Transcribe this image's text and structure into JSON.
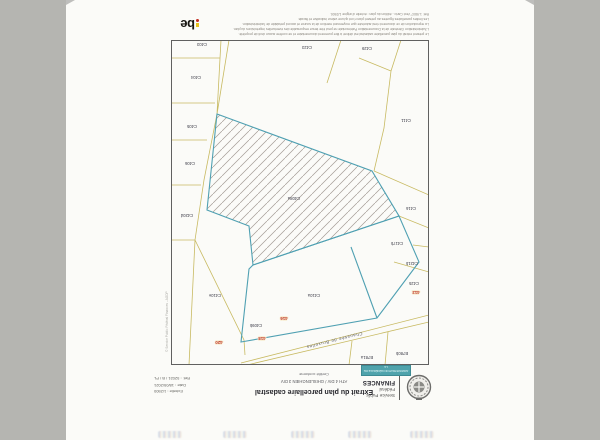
{
  "window": {
    "background": "#b5b5b1",
    "paper": "#fbfbf8"
  },
  "header": {
    "agency": {
      "line1": "Service Public",
      "line2": "Fédéral",
      "line3": "FINANCES"
    },
    "title": "Extrait du plan parcellaire cadastral",
    "division_line": "ATH 4 DIV / GHISLENGHIEN 3 DIV",
    "certified_line": "Certifié conforme",
    "info": {
      "scale": "Echelle : 1/2500",
      "date": "Date : 18/05/2021",
      "ref": "Réf. : 52021 / B / PL"
    },
    "stamp": {
      "line1": "ADMINISTRATION GÉNÉRALE DE LA",
      "line2": "DOCUMENTATION PATRIMONIALE",
      "color": "#4fa3ac"
    }
  },
  "map": {
    "street_label": "Chaussée de Bruxelles",
    "side_note": "© Service Public Fédéral Finances - AGDP",
    "colors": {
      "parcel_line": "#c8ba62",
      "highlight_line": "#4fa0b2",
      "hatch": "#a59d95",
      "label": "#3c3c48",
      "house_number": "#c0392b",
      "frame": "#606060"
    },
    "hatched_parcel": "C408a",
    "parcels": [
      {
        "label": "C403"
      },
      {
        "label": "C404"
      },
      {
        "label": "C405"
      },
      {
        "label": "C406"
      },
      {
        "label": "C420d"
      },
      {
        "label": "C410e"
      },
      {
        "label": "C409b"
      },
      {
        "label": "C408a"
      },
      {
        "label": "C410a"
      },
      {
        "label": "C423"
      },
      {
        "label": "C429"
      },
      {
        "label": "C411"
      },
      {
        "label": "C416"
      },
      {
        "label": "C417b"
      },
      {
        "label": "C421b"
      },
      {
        "label": "C425"
      },
      {
        "label": "B780b"
      },
      {
        "label": "B781a"
      }
    ],
    "house_numbers": [
      {
        "label": "420"
      },
      {
        "label": "418"
      },
      {
        "label": "416"
      },
      {
        "label": "412"
      }
    ]
  },
  "footer": {
    "disclaimer_lines": [
      "Le présent extrait du plan parcellaire cadastral est délivré à titre purement documentaire et ne confère aucun droit de propriété.",
      "L'Administration Générale de la Documentation Patrimoniale ne peut être tenue responsable des éventuelles imprécisions du plan.",
      "La reproduction de ce document n'est autorisée que moyennant mention de la source et accord préalable de l'administration.",
      "Les limites parcellaires figurées au présent plan n'ont qu'une valeur indicative et fiscale.",
      "Réf. 1-9807 Vect Carto - édition du plan : échelle d'origine 1/2500."
    ],
    "be_logo": "be"
  }
}
